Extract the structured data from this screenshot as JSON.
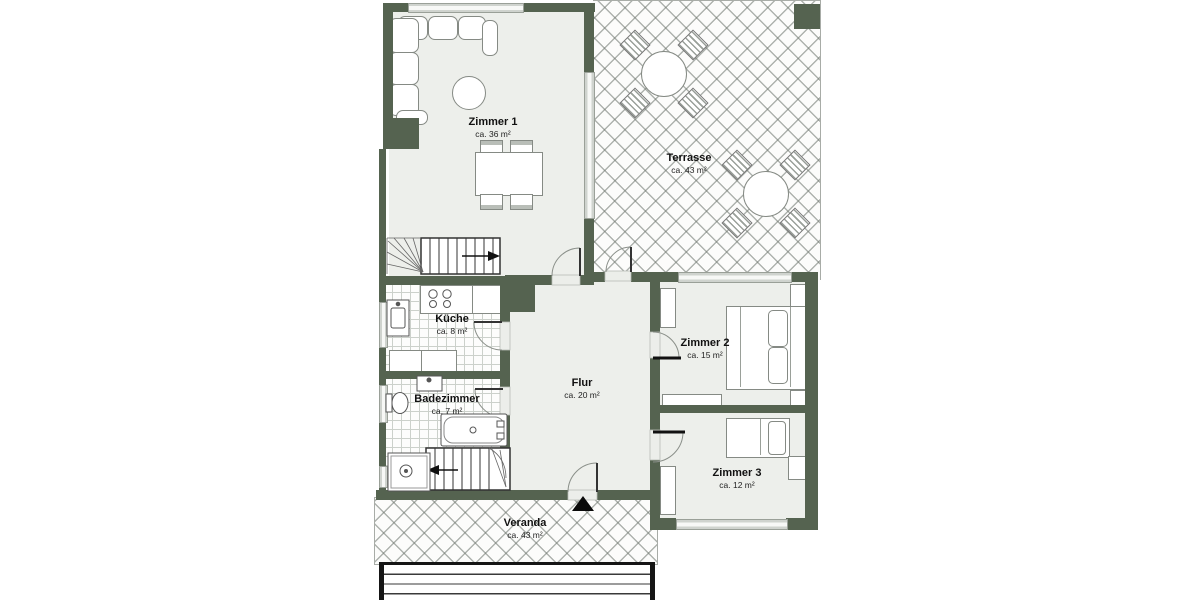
{
  "plan": {
    "rooms": {
      "zimmer1": {
        "name": "Zimmer 1",
        "area": "ca. 36 m²"
      },
      "terrasse": {
        "name": "Terrasse",
        "area": "ca. 43 m²"
      },
      "kueche": {
        "name": "Küche",
        "area": "ca. 8 m²"
      },
      "badezimmer": {
        "name": "Badezimmer",
        "area": "ca. 7 m²"
      },
      "flur": {
        "name": "Flur",
        "area": "ca. 20 m²"
      },
      "zimmer2": {
        "name": "Zimmer 2",
        "area": "ca. 15 m²"
      },
      "zimmer3": {
        "name": "Zimmer 3",
        "area": "ca. 12 m²"
      },
      "veranda": {
        "name": "Veranda",
        "area": "ca. 43 m²"
      }
    },
    "colors": {
      "wall": "#556350",
      "floor": "#edefeb",
      "window_glass": "#d5d8d3",
      "hatch_line": "#6e766e"
    }
  }
}
